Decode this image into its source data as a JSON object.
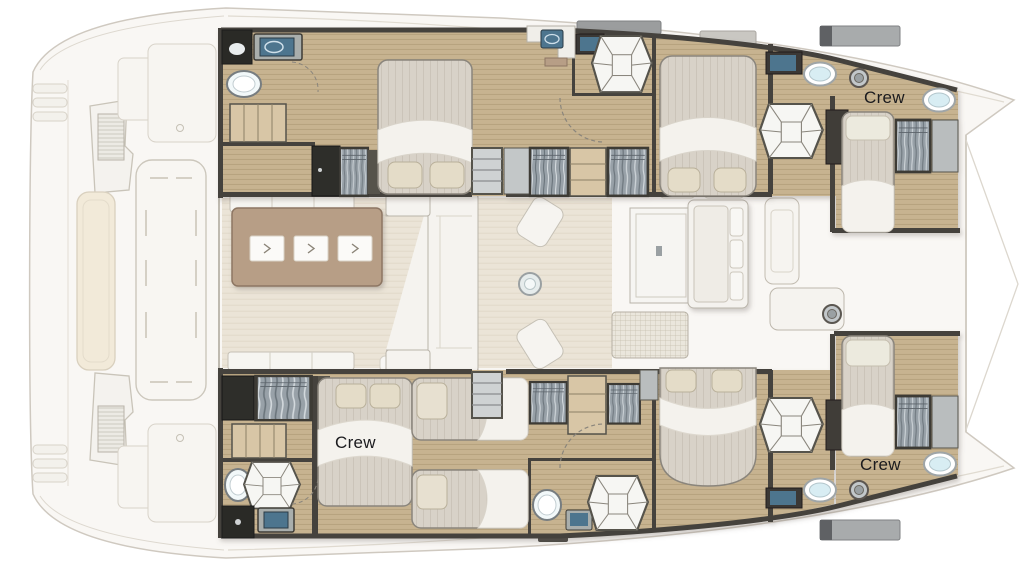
{
  "plan": {
    "type": "catamaran-deck-floorplan",
    "labels": {
      "crew_port_bow": {
        "text": "Crew"
      },
      "crew_starboard_aft": {
        "text": "Crew"
      },
      "crew_starboard_bow": {
        "text": "Crew"
      }
    },
    "palette": {
      "wall": "#45423d",
      "dark_unit": "#2c2b28",
      "wood_floor": "#c7b390",
      "salon_floor": "#ebe4d7",
      "table_brown": "#b79e86",
      "furniture_white": "#f5f3ef",
      "mattress": "#d8d2c8",
      "pillow": "#e4dcc8",
      "wardrobe_gray": "#98a1a8",
      "sink_blue": "#4e748e",
      "fixture_white": "#f2f8f9",
      "deck_faint": "#f9f7f4",
      "outline_faint": "#cfc9c0"
    }
  }
}
